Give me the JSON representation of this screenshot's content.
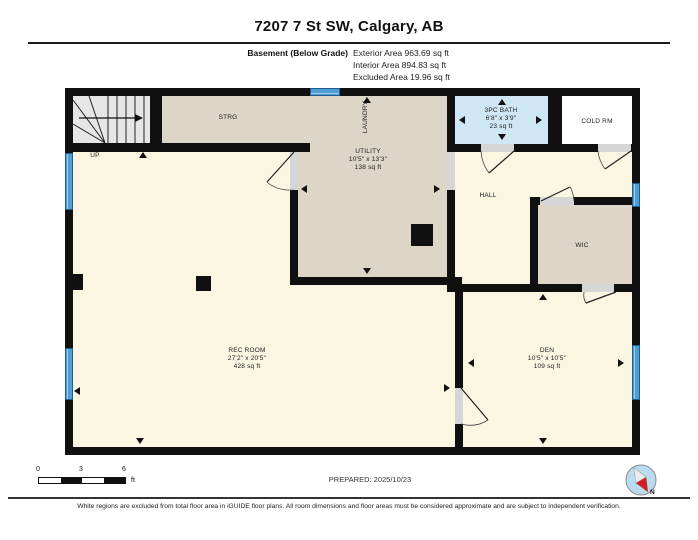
{
  "title": "7207 7 St SW, Calgary, AB",
  "header": {
    "floor_label": "Basement (Below Grade)",
    "areas": [
      "Exterior Area 963.69 sq ft",
      "Interior Area 894.83 sq ft",
      "Excluded Area 19.96 sq ft"
    ]
  },
  "rooms": {
    "strg": {
      "name": "STRG"
    },
    "laundry": {
      "name": "LAUNDRY"
    },
    "utility": {
      "name": "UTILITY",
      "dims": "10'5\" x 13'3\"",
      "area": "138 sq ft"
    },
    "bath": {
      "name": "3PC BATH",
      "dims": "6'8\" x 3'9\"",
      "area": "23 sq ft"
    },
    "cold": {
      "name": "COLD RM"
    },
    "hall": {
      "name": "HALL"
    },
    "wic": {
      "name": "WIC"
    },
    "rec": {
      "name": "REC ROOM",
      "dims": "27'2\" x 20'5\"",
      "area": "428 sq ft"
    },
    "den": {
      "name": "DEN",
      "dims": "10'5\" x 10'5\"",
      "area": "109 sq ft"
    },
    "up_label": "UP"
  },
  "footer": {
    "scale": {
      "t0": "0",
      "t3": "3",
      "t6": "6",
      "unit": "ft"
    },
    "prepared": "PREPARED: 2025/10/23",
    "disclaimer": "White regions are excluded from total floor area in iGUIDE floor plans. All room dimensions and floor areas must be considered approximate and are subject to independent verification.",
    "compass_n": "N"
  },
  "colors": {
    "room_cream": "#faf6e2",
    "room_tan": "#ddd5c6",
    "bath_blue": "#cfe6f5",
    "window_blue": "#4f9fd4",
    "wall": "#101010",
    "compass_red": "#cc2222"
  }
}
